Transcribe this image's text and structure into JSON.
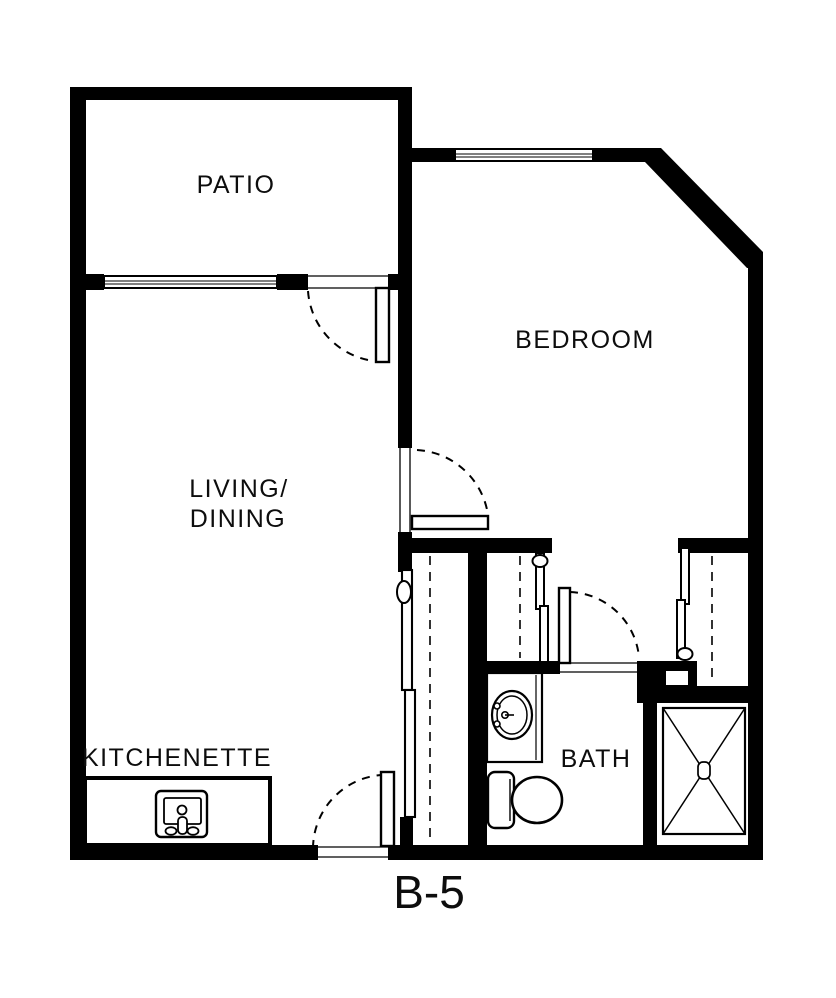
{
  "plan": {
    "title": "B-5",
    "rooms": {
      "patio": "PATIO",
      "bedroom": "BEDROOM",
      "living_line1": "LIVING/",
      "living_line2": "DINING",
      "kitchenette": "KITCHENETTE",
      "bath": "BATH"
    },
    "colors": {
      "wall": "#000000",
      "background": "#ffffff"
    }
  }
}
